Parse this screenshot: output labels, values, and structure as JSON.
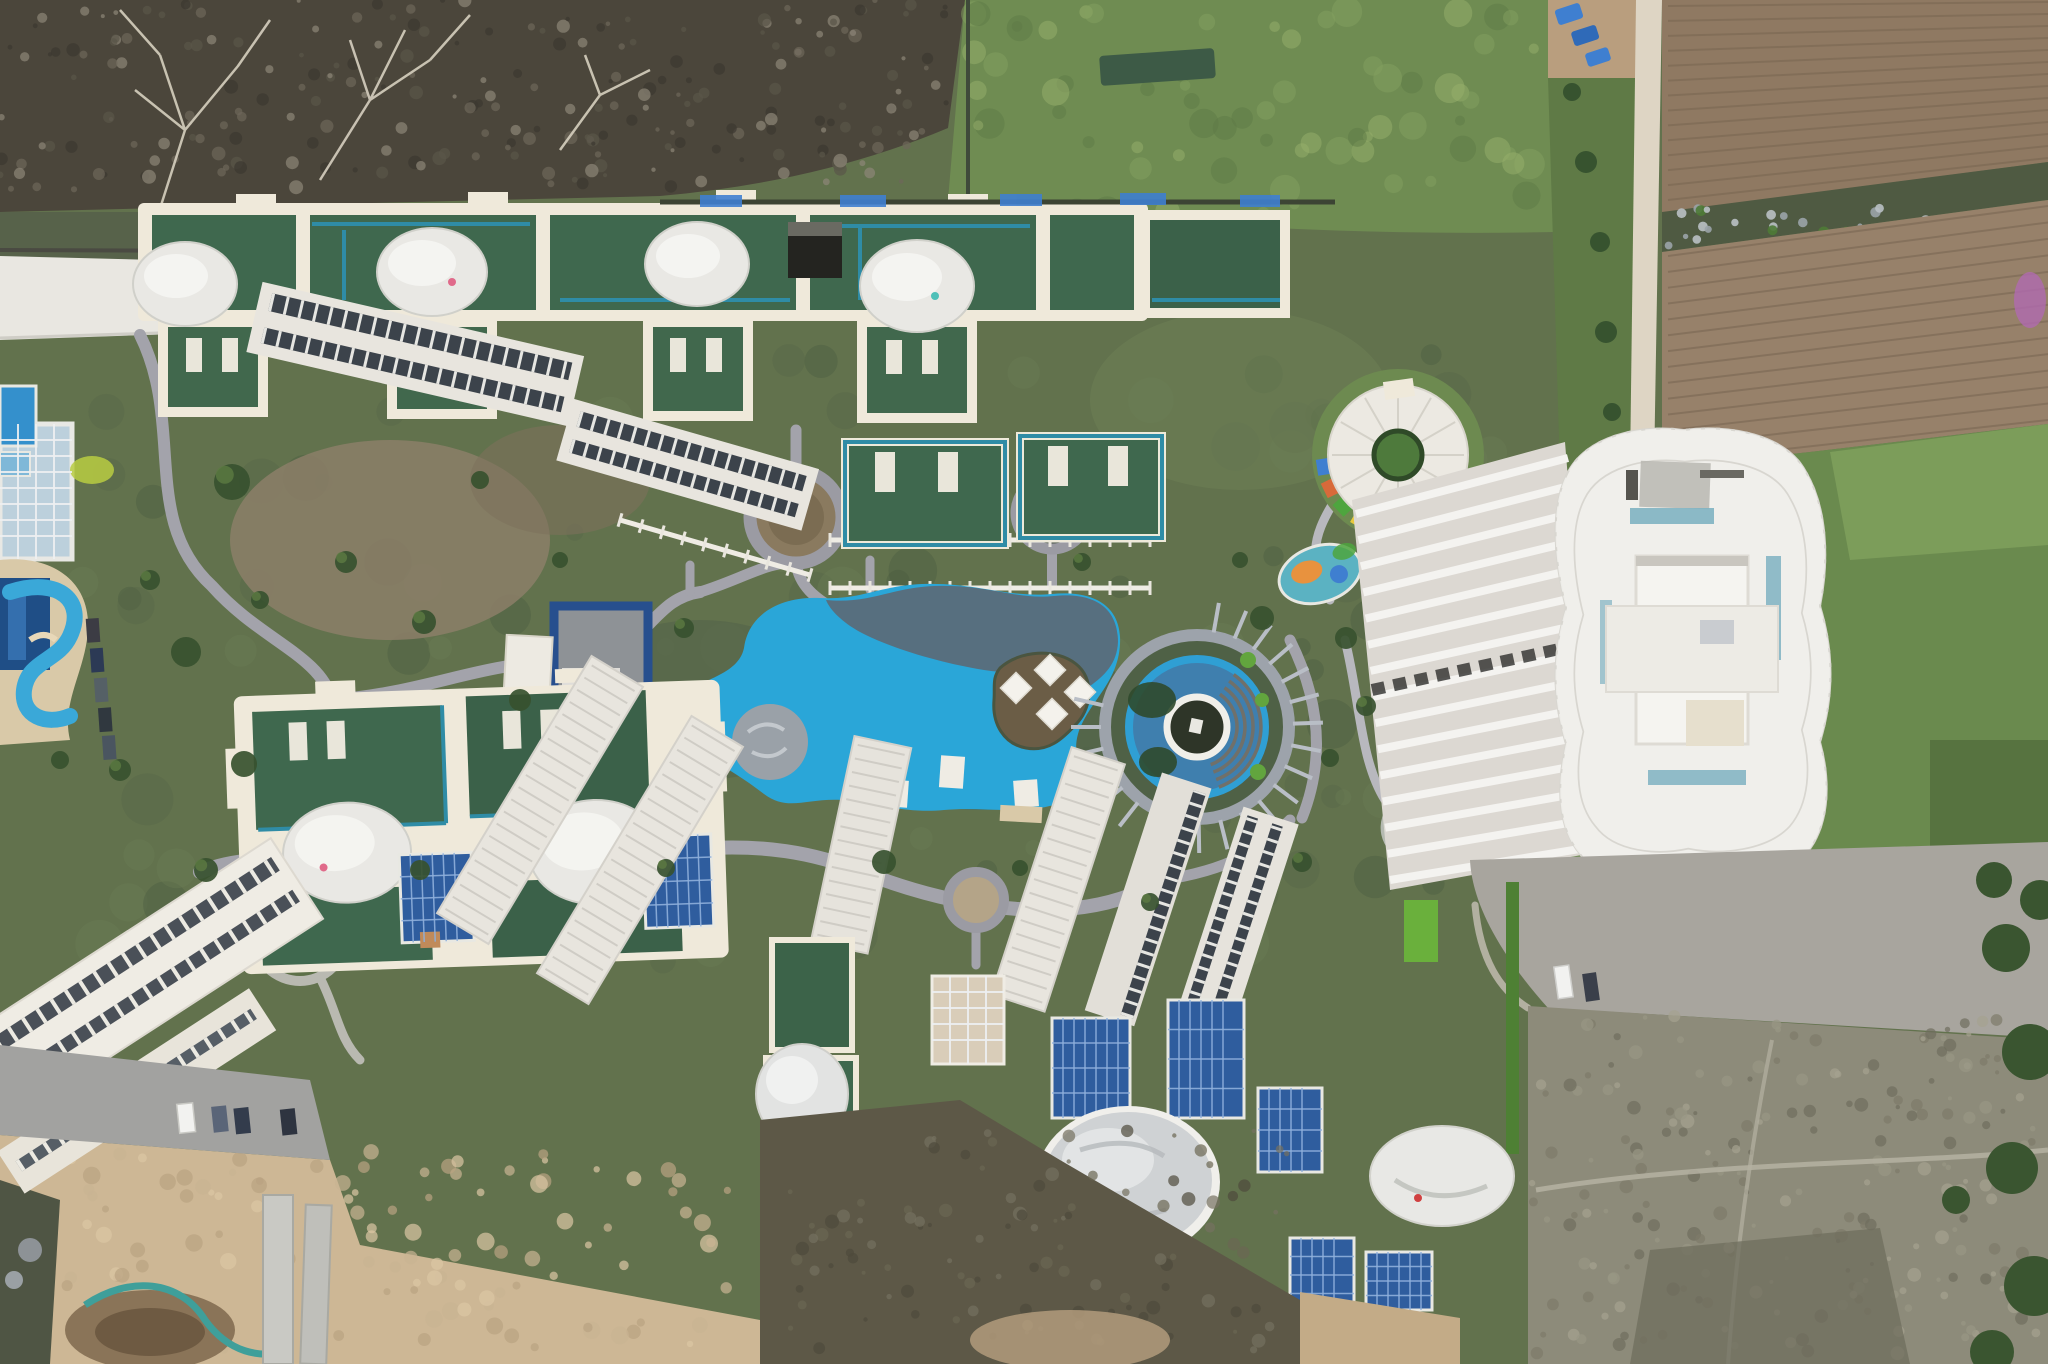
{
  "scene": {
    "type": "aerial-drone-photo",
    "title": "top-down aerial view of a resort-style residential complex",
    "features": [
      "bare-scrubland-top-left",
      "green-meadow-top-center",
      "plowed-fields-top-right",
      "white-perimeter-road",
      "green-roof-apartment-blocks",
      "white-dome-skylights",
      "free-form-swimming-pool-with-shade-sail",
      "pool-island-with-umbrellas",
      "circular-amphitheatre-with-water-ring",
      "round-pavilion-roof",
      "high-rise-tower-top-and-facade",
      "oval-playground",
      "solar-panel-arrays",
      "construction-sand-area-bottom-left",
      "waste-ground-bottom-right",
      "waterpark-lazy-river-left",
      "parked-cars",
      "winding-gray-paths"
    ]
  },
  "colors": {
    "lawn": "#62724d",
    "scrub": "#4b463b",
    "meadow": "#6f8c52",
    "fieldUpper": "#8f7962",
    "fieldLower": "#97816a",
    "fieldGroove": "#7a6753",
    "hedgeBand": "#4f5a42",
    "dirtRoad": "#ded5c4",
    "dirtStrip": "#b99e7e",
    "tarpBlue": "#3f7fd0",
    "grassRight": "#6a8a4e",
    "whiteRoad": "#e9e7e1",
    "path": "#a3a3ab",
    "cream": "#efe9da",
    "roofGreen": "#3f684e",
    "roofGreenDark": "#35594a",
    "teal": "#2f8ca6",
    "domeWhite": "#e9e8e4",
    "windowDark": "#3c434b",
    "poolBlue": "#2aa6d8",
    "poolShade": "#5b6a77",
    "islandBrown": "#6b5d46",
    "deckGray": "#9aa1a8",
    "courtNavy": "#274f8e",
    "courtGray": "#8e9296",
    "amphiWater": "#3f7fae",
    "amphiWhite": "#e8e7e1",
    "amphiCenter": "#2e3528",
    "pavRoof": "#ece9e2",
    "pavCenter": "#4e7a3c",
    "playOrange": "#d2684a",
    "playTeal": "#93b5ab",
    "playBlue": "#5b9fd8",
    "towerWhite": "#f0efeb",
    "facadeBase": "#dcd8d2",
    "facadeStripe": "#f4f3f0",
    "glassTeal": "#7fb2c2",
    "roadGray": "#a8a59e",
    "wasteGround": "#8d8b7a",
    "hedgeGreen": "#4e8034",
    "solarBlue": "#2f5d9e",
    "solarGrid": "#8fb0dc",
    "slabWhite": "#e8e5de",
    "ridgeLine": "#cbc8c1",
    "domeGray": "#cfd2d4",
    "tan": "#d9cdb9",
    "sand": "#cdb795",
    "soilDark": "#5d5847",
    "glassBlue": "#bcd0dc",
    "navyPool": "#1f4e86",
    "waterSlide": "#3aa8d8",
    "treeDark": "#37512f",
    "bushDark": "#3a5530"
  }
}
